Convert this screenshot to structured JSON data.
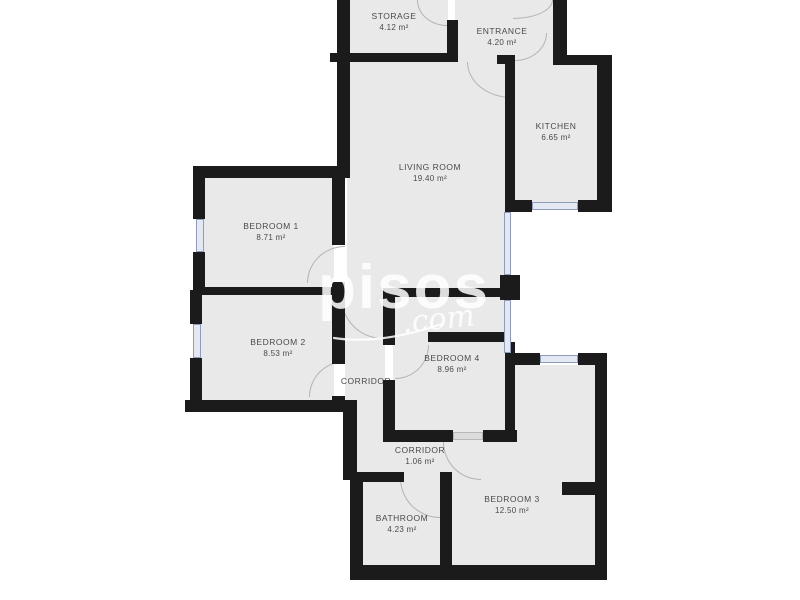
{
  "watermark": {
    "brand": "pisos",
    "tld": ".com"
  },
  "rooms": {
    "storage": {
      "name": "STORAGE",
      "area": "4.12 m²"
    },
    "entrance": {
      "name": "ENTRANCE",
      "area": "4.20 m²"
    },
    "kitchen": {
      "name": "KITCHEN",
      "area": "6.65 m²"
    },
    "living_room": {
      "name": "LIVING ROOM",
      "area": "19.40 m²"
    },
    "bedroom_1": {
      "name": "BEDROOM 1",
      "area": "8.71 m²"
    },
    "bedroom_2": {
      "name": "BEDROOM 2",
      "area": "8.53 m²"
    },
    "bedroom_4": {
      "name": "BEDROOM 4",
      "area": "8.96 m²"
    },
    "corridor_main": {
      "name": "CORRIDOR"
    },
    "corridor_small": {
      "name": "CORRIDOR",
      "area": "1.06 m²"
    },
    "bathroom": {
      "name": "BATHROOM",
      "area": "4.23 m²"
    },
    "bedroom_3": {
      "name": "BEDROOM 3",
      "area": "12.50 m²"
    }
  },
  "colors": {
    "wall": "#1b1b1b",
    "room_fill": "#e9e9e9",
    "background": "#ffffff",
    "window": "#8d9cba",
    "door_arc": "#b3b3b3",
    "label_text": "#4a4a4a",
    "watermark": "#ffffff"
  }
}
